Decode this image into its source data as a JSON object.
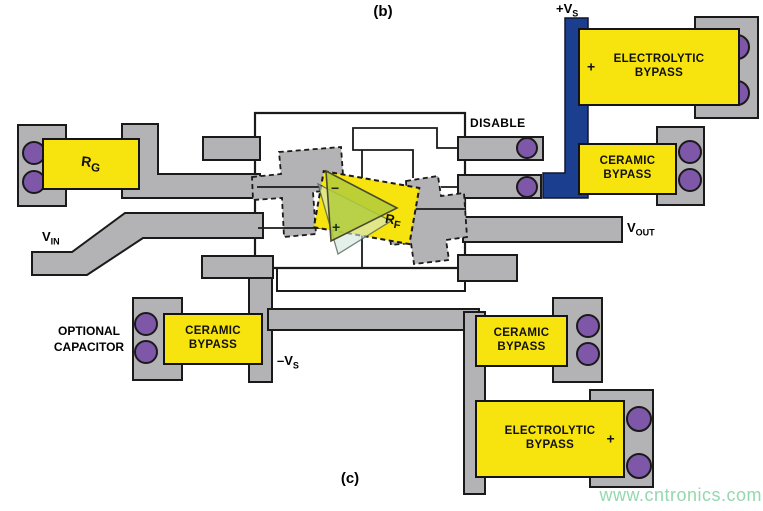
{
  "figure": {
    "panel_label_top": "(b)",
    "panel_label_bottom": "(c)",
    "watermark": "www.cntronics.com"
  },
  "labels": {
    "vs_plus": {
      "text": "+V",
      "sub": "S"
    },
    "vs_minus": {
      "text": "–V",
      "sub": "S"
    },
    "vin": {
      "text": "V",
      "sub": "IN"
    },
    "vout": {
      "text": "V",
      "sub": "OUT"
    },
    "disable": "DISABLE",
    "optional_capacitor": {
      "line1": "OPTIONAL",
      "line2": "CAPACITOR"
    }
  },
  "components": {
    "rg": {
      "text": "R",
      "sub": "G"
    },
    "rf": {
      "text": "R",
      "sub": "F"
    },
    "opamp": {
      "minus": "−",
      "plus": "+"
    },
    "electrolytic_top": {
      "line1": "ELECTROLYTIC",
      "line2": "BYPASS",
      "polarity": "+"
    },
    "ceramic_top": {
      "line1": "CERAMIC",
      "line2": "BYPASS"
    },
    "ceramic_left": {
      "line1": "CERAMIC",
      "line2": "BYPASS"
    },
    "ceramic_bottom": {
      "line1": "CERAMIC",
      "line2": "BYPASS"
    },
    "electrolytic_bottom": {
      "line1": "ELECTROLYTIC",
      "line2": "BYPASS",
      "polarity": "+"
    }
  },
  "colors": {
    "trace_gray": "#b3b2b4",
    "component_yellow": "#f7e30e",
    "via_purple": "#7e57a8",
    "supply_blue": "#1b3e8e",
    "outline_black": "#1a1a1a",
    "opamp_green": "#b2cc3c",
    "watermark_green": "#94d8ae"
  }
}
